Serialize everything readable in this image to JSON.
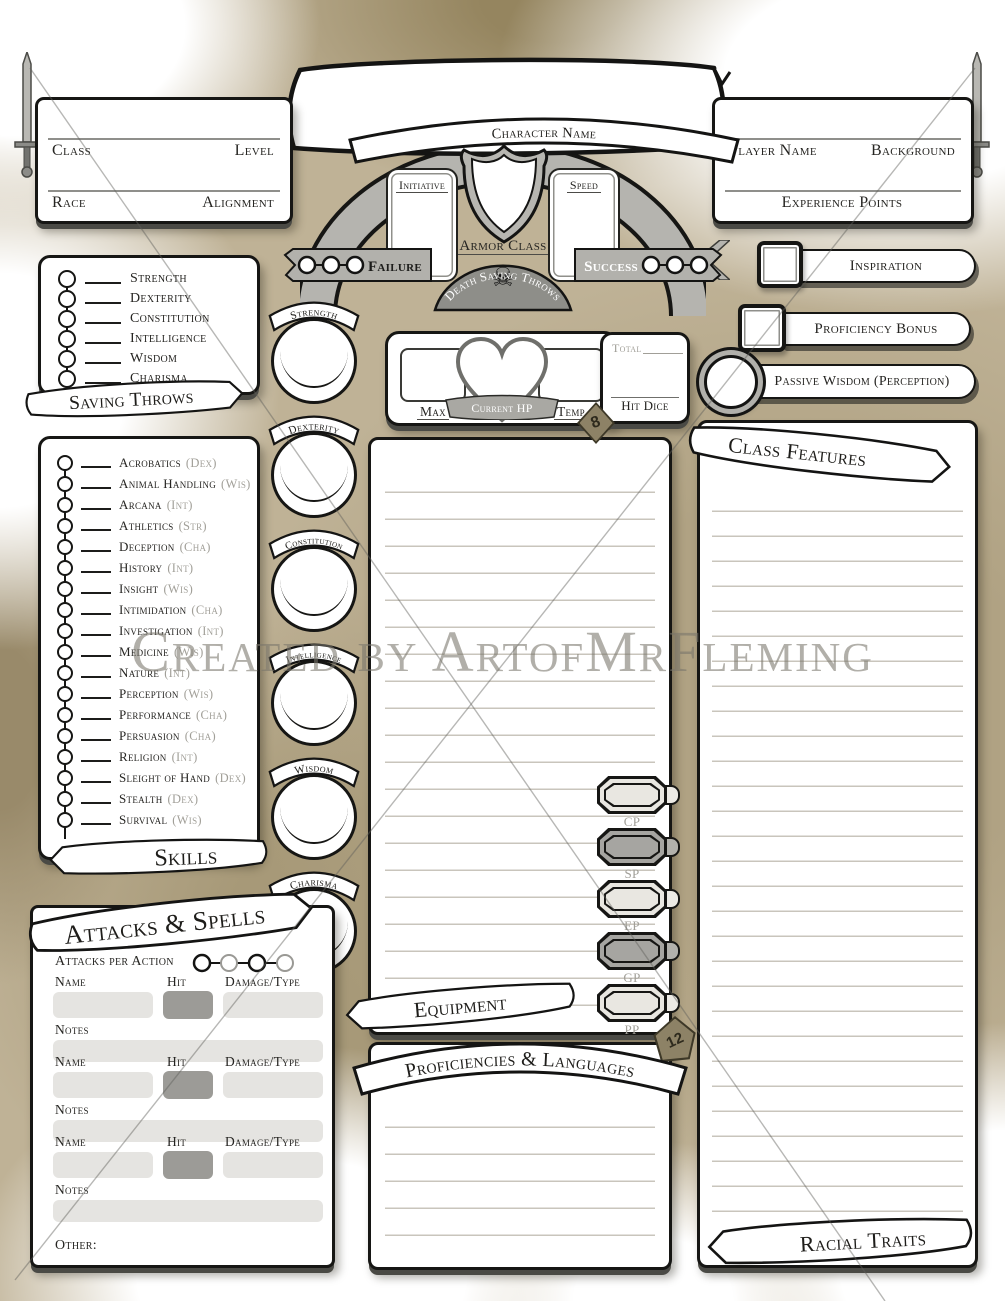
{
  "watermark": {
    "text": "Created by ArtofMrFleming"
  },
  "icons": {
    "skull": "☠"
  },
  "dice": {
    "d8": "8",
    "d12": "12"
  },
  "header": {
    "character_name_label": "Character Name",
    "initiative_label": "Initiative",
    "speed_label": "Speed",
    "armor_class_label": "Armor Class",
    "left_box": {
      "class_label": "Class",
      "level_label": "Level",
      "race_label": "Race",
      "alignment_label": "Alignment"
    },
    "right_box": {
      "player_name_label": "Player Name",
      "background_label": "Background",
      "experience_label": "Experience Points"
    },
    "death_saves": {
      "title": "Death Saving Throws",
      "failure_label": "Failure",
      "success_label": "Success"
    }
  },
  "right_panel": {
    "inspiration_label": "Inspiration",
    "proficiency_bonus_label": "Proficiency Bonus",
    "passive_wisdom_label": "Passive Wisdom (Perception)"
  },
  "saving_throws": {
    "banner": "Saving Throws",
    "items": [
      "Strength",
      "Dexterity",
      "Constitution",
      "Intelligence",
      "Wisdom",
      "Charisma"
    ]
  },
  "abilities": {
    "items": [
      {
        "name": "Strength"
      },
      {
        "name": "Dexterity"
      },
      {
        "name": "Constitution"
      },
      {
        "name": "Intelligence"
      },
      {
        "name": "Wisdom"
      },
      {
        "name": "Charisma"
      }
    ]
  },
  "hp": {
    "max_label": "Max",
    "current_label": "Current HP",
    "temp_label": "Temp"
  },
  "hit_dice": {
    "total_label": "Total",
    "label": "Hit Dice"
  },
  "skills": {
    "banner": "Skills",
    "items": [
      {
        "name": "Acrobatics",
        "ability": "(Dex)"
      },
      {
        "name": "Animal Handling",
        "ability": "(Wis)"
      },
      {
        "name": "Arcana",
        "ability": "(Int)"
      },
      {
        "name": "Athletics",
        "ability": "(Str)"
      },
      {
        "name": "Deception",
        "ability": "(Cha)"
      },
      {
        "name": "History",
        "ability": "(Int)"
      },
      {
        "name": "Insight",
        "ability": "(Wis)"
      },
      {
        "name": "Intimidation",
        "ability": "(Cha)"
      },
      {
        "name": "Investigation",
        "ability": "(Int)"
      },
      {
        "name": "Medicine",
        "ability": "(Wis)"
      },
      {
        "name": "Nature",
        "ability": "(Int)"
      },
      {
        "name": "Perception",
        "ability": "(Wis)"
      },
      {
        "name": "Performance",
        "ability": "(Cha)"
      },
      {
        "name": "Persuasion",
        "ability": "(Cha)"
      },
      {
        "name": "Religion",
        "ability": "(Int)"
      },
      {
        "name": "Sleight of Hand",
        "ability": "(Dex)"
      },
      {
        "name": "Stealth",
        "ability": "(Dex)"
      },
      {
        "name": "Survival",
        "ability": "(Wis)"
      }
    ]
  },
  "attacks": {
    "banner": "Attacks & Spells",
    "per_action_label": "Attacks per Action",
    "name_label": "Name",
    "hit_label": "Hit",
    "damage_label": "Damage/Type",
    "notes_label": "Notes",
    "other_label": "Other:"
  },
  "equipment": {
    "banner": "Equipment",
    "currency": [
      {
        "code": "CP"
      },
      {
        "code": "SP"
      },
      {
        "code": "EP"
      },
      {
        "code": "GP"
      },
      {
        "code": "PP"
      }
    ]
  },
  "proficiencies": {
    "banner": "Proficiencies & Languages"
  },
  "class_features": {
    "banner": "Class Features"
  },
  "racial_traits": {
    "banner": "Racial Traits"
  }
}
